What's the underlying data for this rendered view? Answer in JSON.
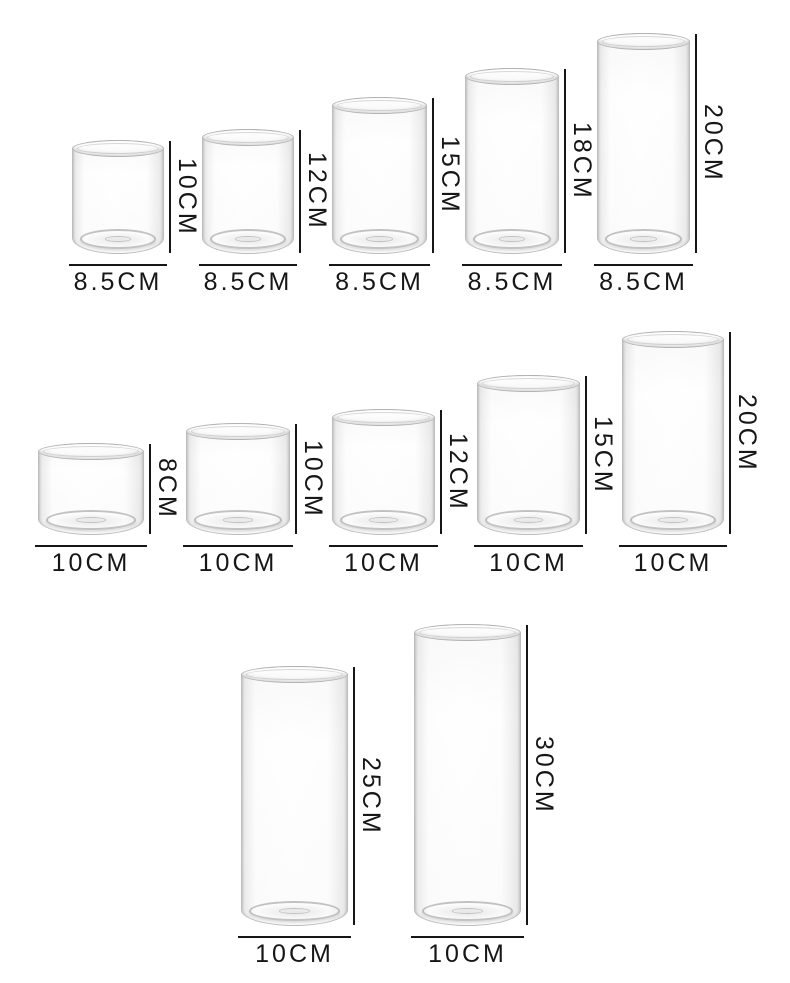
{
  "colors": {
    "background": "#ffffff",
    "dimension_line": "#161616",
    "label_text": "#161616",
    "glass_outline": "#bdbdbd"
  },
  "rows": [
    {
      "items": [
        {
          "height_cm": 10,
          "diameter_cm": 8.5,
          "height_label": "10CM",
          "diameter_label": "8.5CM"
        },
        {
          "height_cm": 12,
          "diameter_cm": 8.5,
          "height_label": "12CM",
          "diameter_label": "8.5CM"
        },
        {
          "height_cm": 15,
          "diameter_cm": 8.5,
          "height_label": "15CM",
          "diameter_label": "8.5CM"
        },
        {
          "height_cm": 18,
          "diameter_cm": 8.5,
          "height_label": "18CM",
          "diameter_label": "8.5CM"
        },
        {
          "height_cm": 20,
          "diameter_cm": 8.5,
          "height_label": "20CM",
          "diameter_label": "8.5CM"
        }
      ]
    },
    {
      "items": [
        {
          "height_cm": 8,
          "diameter_cm": 10,
          "height_label": "8CM",
          "diameter_label": "10CM"
        },
        {
          "height_cm": 10,
          "diameter_cm": 10,
          "height_label": "10CM",
          "diameter_label": "10CM"
        },
        {
          "height_cm": 12,
          "diameter_cm": 10,
          "height_label": "12CM",
          "diameter_label": "10CM"
        },
        {
          "height_cm": 15,
          "diameter_cm": 10,
          "height_label": "15CM",
          "diameter_label": "10CM"
        },
        {
          "height_cm": 20,
          "diameter_cm": 10,
          "height_label": "20CM",
          "diameter_label": "10CM"
        }
      ]
    },
    {
      "items": [
        {
          "height_cm": 25,
          "diameter_cm": 10,
          "height_label": "25CM",
          "diameter_label": "10CM"
        },
        {
          "height_cm": 30,
          "diameter_cm": 10,
          "height_label": "30CM",
          "diameter_label": "10CM"
        }
      ]
    }
  ]
}
